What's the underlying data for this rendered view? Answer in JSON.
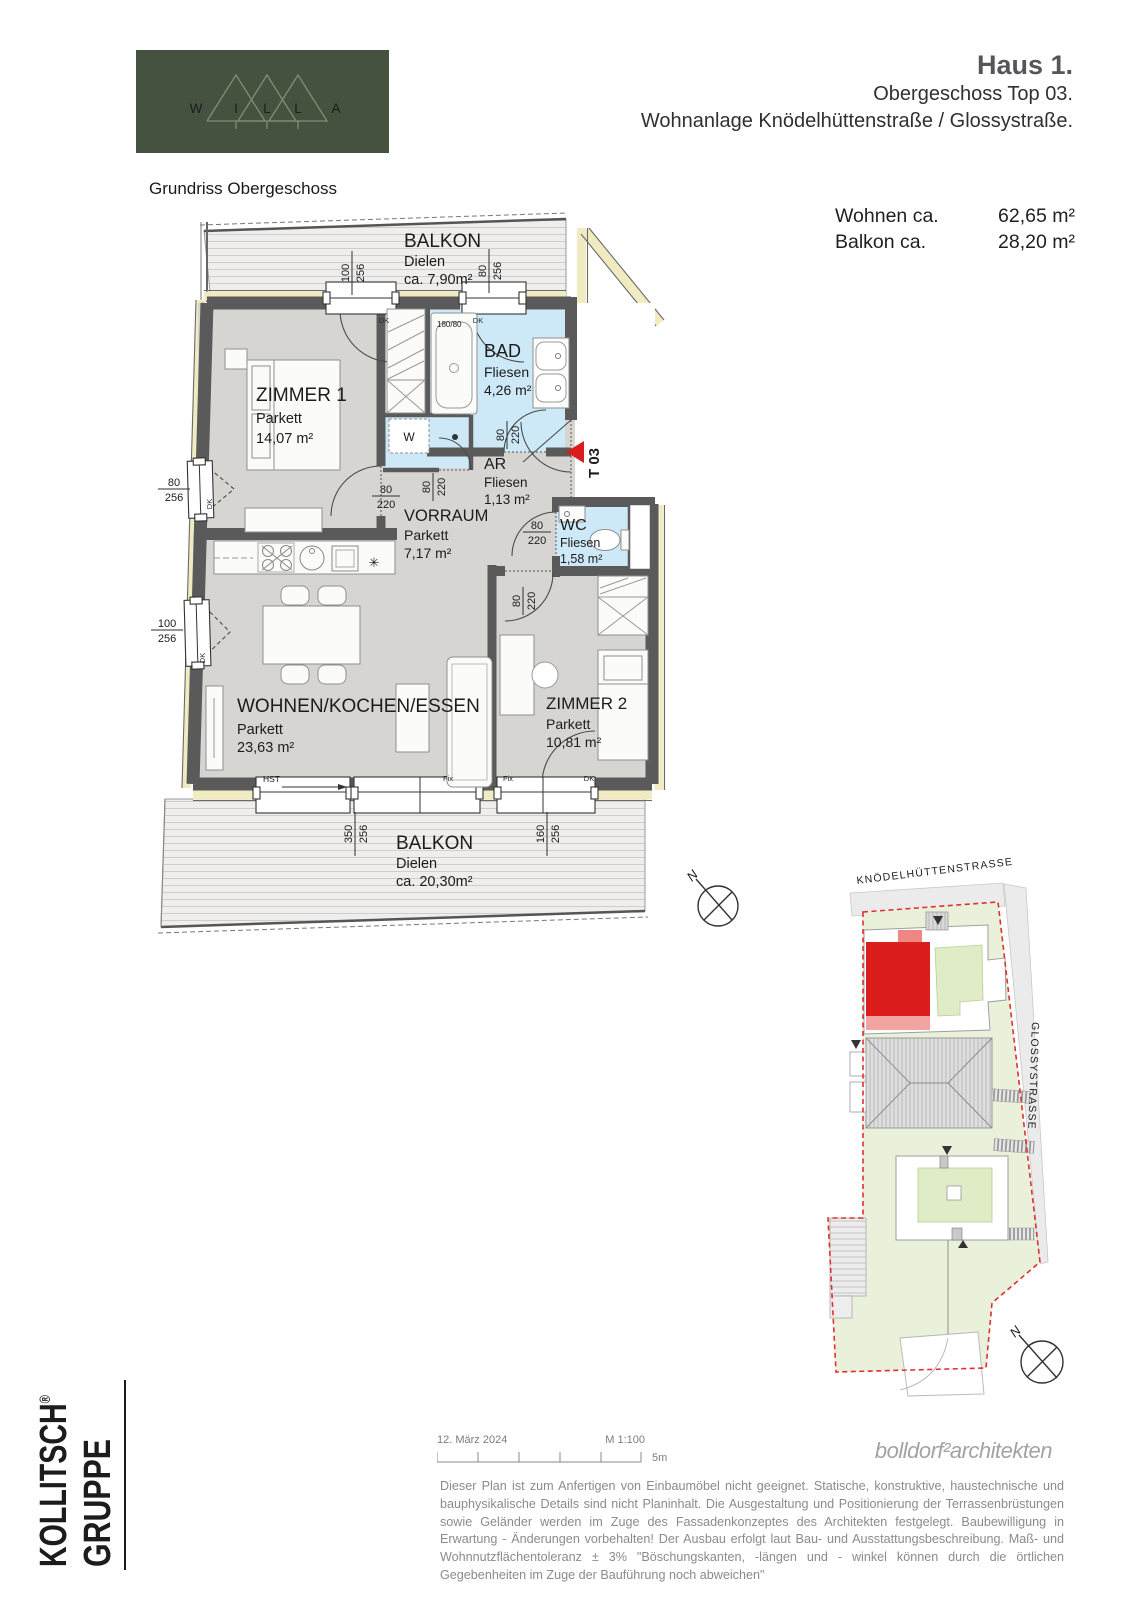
{
  "header": {
    "logo": {
      "letters": [
        "W",
        "I",
        "L",
        "L",
        "A"
      ]
    },
    "title": "Haus 1.",
    "line2": "Obergeschoss Top 03.",
    "line3": "Wohnanlage Knödelhüttenstraße / Glossystraße."
  },
  "plan_title": "Grundriss Obergeschoss",
  "areas": [
    {
      "label": "Wohnen ca.",
      "value": "62,65 m²"
    },
    {
      "label": "Balkon ca.",
      "value": "28,20 m²"
    }
  ],
  "floorplan": {
    "rooms": {
      "balkon_top": {
        "name": "BALKON",
        "floor": "Dielen",
        "area": "ca. 7,90m²"
      },
      "zimmer1": {
        "name": "ZIMMER 1",
        "floor": "Parkett",
        "area": "14,07 m²"
      },
      "bad": {
        "name": "BAD",
        "floor": "Fliesen",
        "area": "4,26 m²"
      },
      "ar": {
        "name": "AR",
        "floor": "Fliesen",
        "area": "1,13 m²"
      },
      "vorraum": {
        "name": "VORRAUM",
        "floor": "Parkett",
        "area": "7,17 m²"
      },
      "wc": {
        "name": "WC",
        "floor": "Fliesen",
        "area": "1,58 m²"
      },
      "wohnen": {
        "name": "WOHNEN/KOCHEN/ESSEN",
        "floor": "Parkett",
        "area": "23,63 m²"
      },
      "zimmer2": {
        "name": "ZIMMER 2",
        "floor": "Parkett",
        "area": "10,81 m²"
      },
      "balkon_bottom": {
        "name": "BALKON",
        "floor": "Dielen",
        "area": "ca. 20,30m²"
      }
    },
    "dims": {
      "w1": {
        "a": "100",
        "b": "256"
      },
      "w2": {
        "a": "80",
        "b": "256"
      },
      "w3": {
        "a": "80",
        "b": "256"
      },
      "w4": {
        "a": "100",
        "b": "256"
      },
      "w5": {
        "a": "350",
        "b": "256"
      },
      "w6": {
        "a": "160",
        "b": "256"
      },
      "d1": {
        "a": "80",
        "b": "220"
      },
      "d2": {
        "a": "80",
        "b": "220"
      },
      "d3": {
        "a": "80",
        "b": "220"
      },
      "d4": {
        "a": "80",
        "b": "220"
      },
      "d5": {
        "a": "80",
        "b": "220"
      }
    },
    "labels": {
      "dk": "DK",
      "fix": "Fix",
      "hst": "HST",
      "washer": "W",
      "tub": "180/80",
      "star": "✳",
      "unit": "T 03",
      "north": "N"
    }
  },
  "siteplan": {
    "street_top": "KNÖDELHÜTTENSTRASSE",
    "street_right": "GLOSSYSTRASSE"
  },
  "footer": {
    "company_line1": "KOLLITSCH",
    "company_reg": "®",
    "company_line2": "GRUPPE",
    "date": "12. März 2024",
    "scale": "M 1:100",
    "scale_end": "5m",
    "architect": "bolldorf²architekten",
    "disclaimer": "Dieser Plan ist zum Anfertigen von Einbaumöbel nicht geeignet. Statische, konstruktive, haustechnische und bauphysikalische Details sind nicht Planinhalt. Die Ausgestaltung und Positionierung der Terrassenbrüstungen sowie Geländer werden im Zuge des Fassadenkonzeptes des Architekten festgelegt. Baubewilligung in Erwartung - Änderungen vorbehalten! Der Ausbau erfolgt laut Bau- und Ausstattungsbeschreibung. Maß- und Wohnnutzflächentoleranz ± 3% \"Böschungskanten, -längen und - winkel können durch die örtlichen Gegebenheiten im Zuge der Bauführung noch abweichen\""
  },
  "colors": {
    "kollitsch_red": "#e32a2e",
    "unit_red": "#dc1d1d",
    "logo_green": "#44523f",
    "tile_blue": "#cde9f7",
    "wall_gray": "#5a5a5a",
    "insulation_yellow": "#f0ebc0",
    "site_green": "#e9f1da",
    "boundary_red": "#e03030"
  }
}
